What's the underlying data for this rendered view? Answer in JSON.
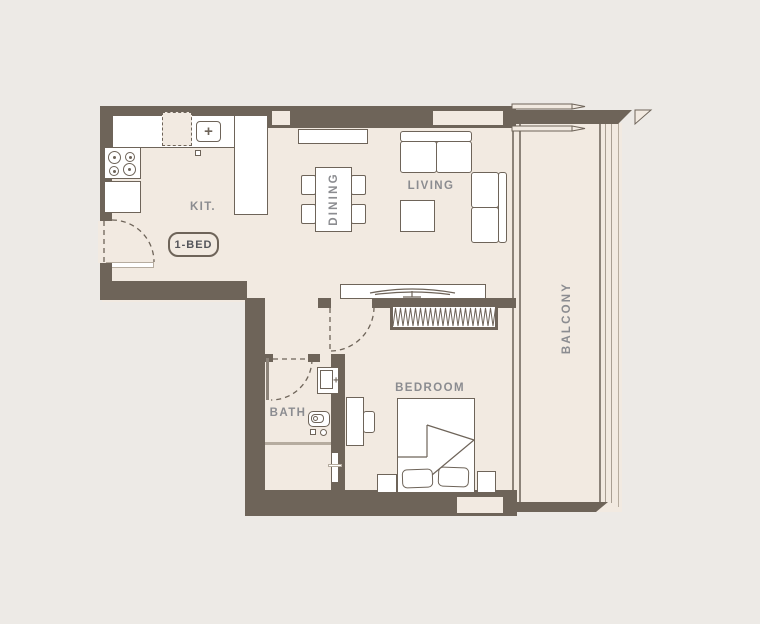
{
  "plan": {
    "unit_type_badge": "1-BED",
    "rooms": {
      "kitchen": "KIT.",
      "dining": "DINING",
      "living": "LIVING",
      "balcony": "BALCONY",
      "bedroom": "BEDROOM",
      "bath": "BATH"
    },
    "icons": {
      "sink_faucet": "+",
      "bath_faucet": "+"
    },
    "colors": {
      "background": "#edeae6",
      "floor": "#f2eae1",
      "wall": "#6e6459",
      "furniture_fill": "#ffffff",
      "outline": "#6e6459",
      "label_text": "#8b8c90",
      "badge_text": "#54555a",
      "light_line": "#b6ac9f",
      "glass_line": "#8c8379",
      "rail_light": "#a89e92"
    }
  }
}
